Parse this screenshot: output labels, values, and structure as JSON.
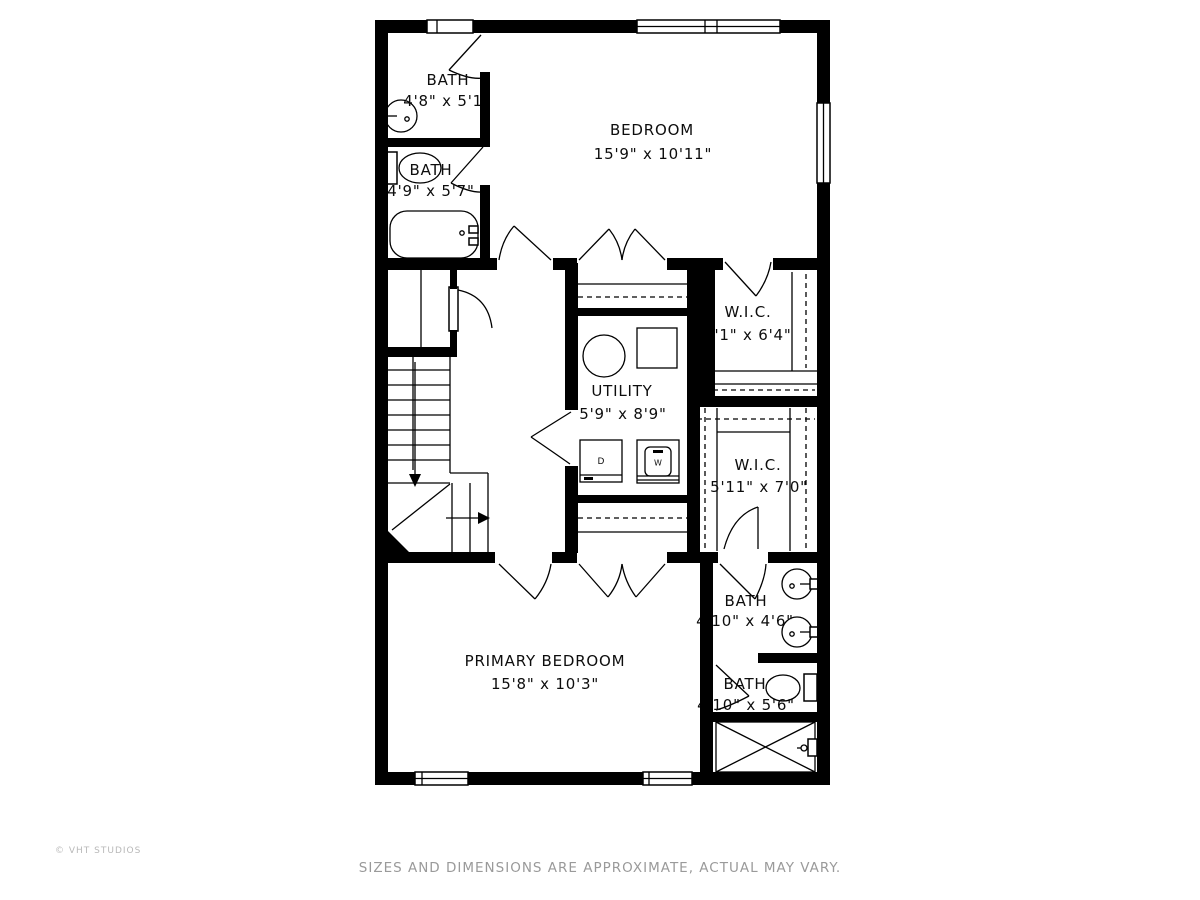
{
  "meta": {
    "wall_color": "#000000",
    "line_color": "#000000",
    "background": "#ffffff",
    "footer_color": "#9a9a9a",
    "credit_color": "#b8b8b8"
  },
  "rooms": [
    {
      "id": "bath1",
      "name": "BATH",
      "dims": "4'8\" x 5'1\""
    },
    {
      "id": "bath2",
      "name": "BATH",
      "dims": "4'9\" x 5'7\""
    },
    {
      "id": "bedroom",
      "name": "BEDROOM",
      "dims": "15'9\" x 10'11\""
    },
    {
      "id": "wic1",
      "name": "W.I.C.",
      "dims": "'1\" x 6'4\""
    },
    {
      "id": "utility",
      "name": "UTILITY",
      "dims": "5'9\" x 8'9\""
    },
    {
      "id": "wic2",
      "name": "W.I.C.",
      "dims": "5'11\" x 7'0\""
    },
    {
      "id": "bath3",
      "name": "BATH",
      "dims": "4'10\" x 4'6\""
    },
    {
      "id": "bath4",
      "name": "BATH",
      "dims": "4'10\" x 5'6\""
    },
    {
      "id": "primary",
      "name": "PRIMARY BEDROOM",
      "dims": "15'8\" x 10'3\""
    }
  ],
  "appliances": {
    "dryer": "D",
    "washer": "W"
  },
  "footer": {
    "disclaimer": "SIZES AND DIMENSIONS ARE APPROXIMATE, ACTUAL MAY VARY."
  },
  "credit": {
    "text": "© VHT STUDIOS"
  }
}
